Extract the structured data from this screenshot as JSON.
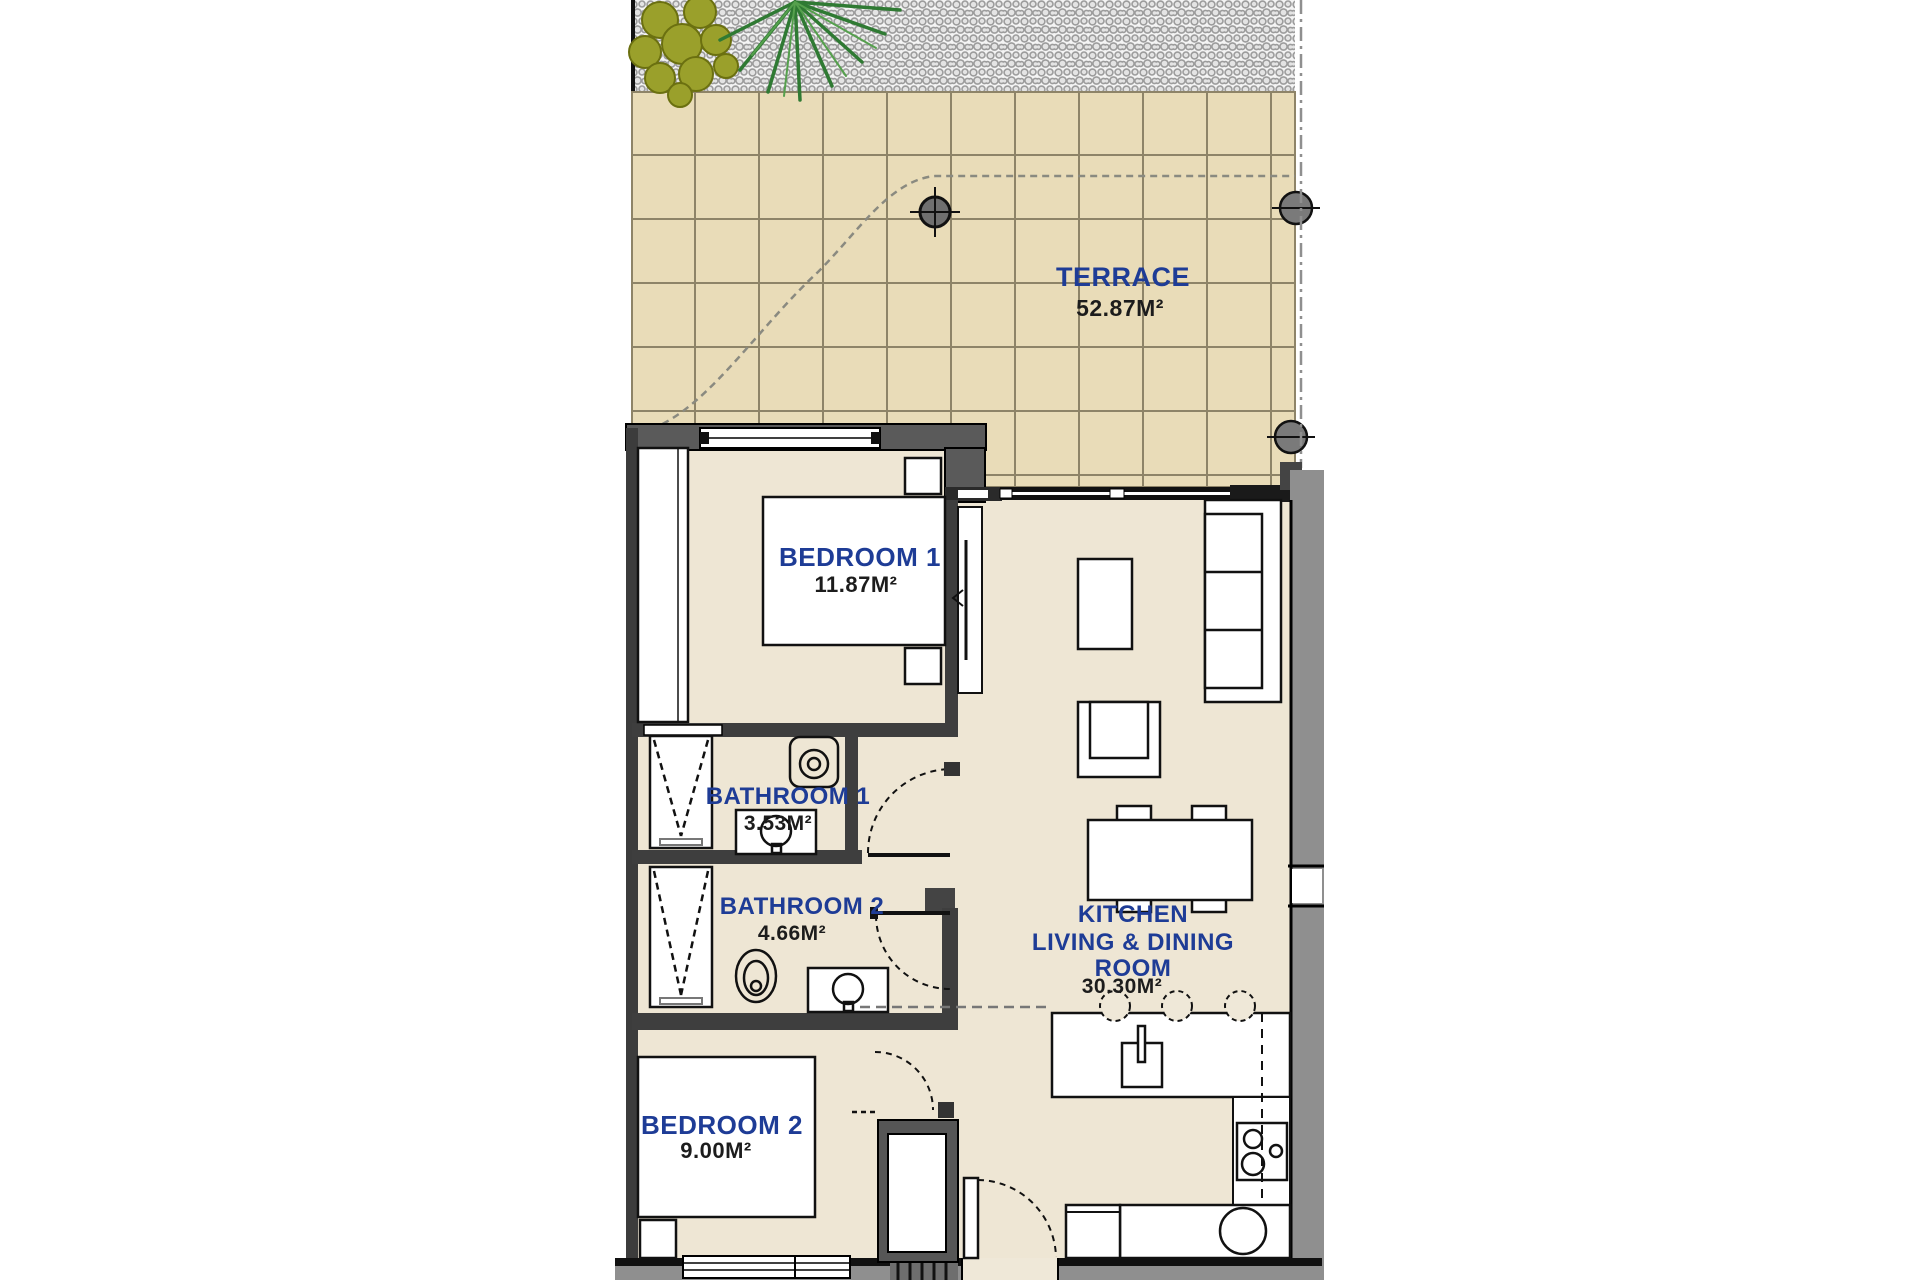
{
  "plan": {
    "rooms": {
      "terrace": {
        "name": "TERRACE",
        "area": "52.87M²"
      },
      "bedroom1": {
        "name": "BEDROOM 1",
        "area": "11.87M²"
      },
      "bathroom1": {
        "name": "BATHROOM 1",
        "area": "3.53M²"
      },
      "bathroom2": {
        "name": "BATHROOM 2",
        "area": "4.66M²"
      },
      "bedroom2": {
        "name": "BEDROOM 2",
        "area": "9.00M²"
      },
      "kitchen": {
        "name_lines": [
          "KITCHEN",
          "LIVING & DINING",
          "ROOM"
        ],
        "area": "30.30M²"
      }
    },
    "colors": {
      "label_blue": "#1e3c96",
      "area_text": "#1c1c1c",
      "tile_fill": "#e9dcb8",
      "tile_grout": "#8e8468",
      "interior_floor": "#eee6d4",
      "wall_dark": "#3e3e3e",
      "wall_gray": "#8f8f8f",
      "plant_green": "#2f7a33",
      "bush_olive": "#9aa02b"
    }
  }
}
